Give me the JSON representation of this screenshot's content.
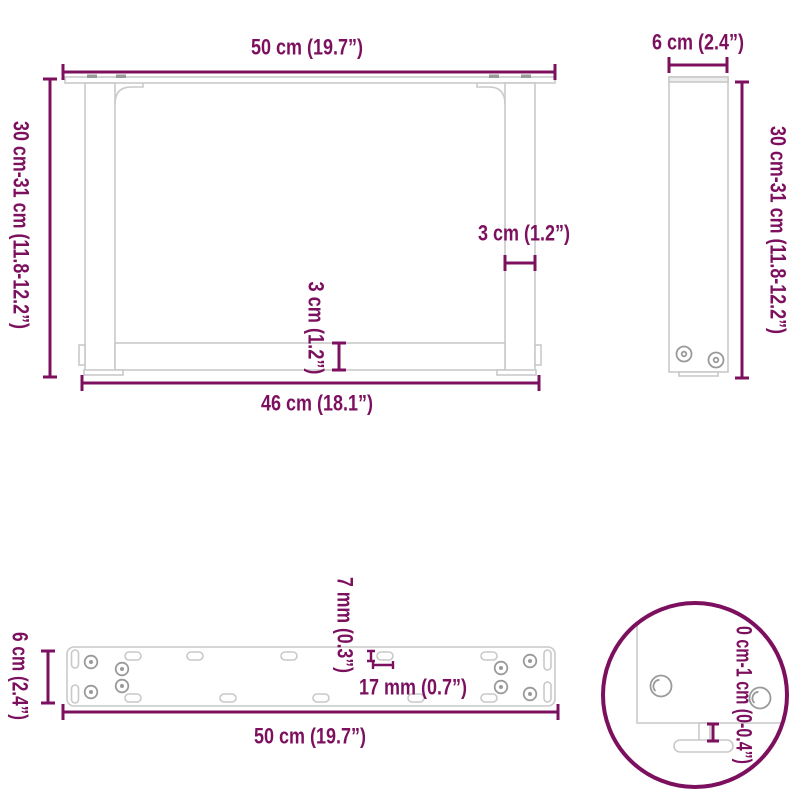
{
  "colors": {
    "accent": "#7C105F",
    "structure": "#C9C9C9",
    "screw": "#9A9A9A",
    "background": "#FFFFFF"
  },
  "front_view": {
    "top_width": "50 cm (19.7”)",
    "height": "30 cm-31 cm (11.8-12.2”)",
    "leg_thickness": "3 cm (1.2”)",
    "crossbar_thickness": "3 cm (1.2”)",
    "bottom_width": "46 cm (18.1”)"
  },
  "side_view": {
    "depth": "6 cm (2.4”)",
    "height": "30 cm-31 cm (11.8-12.2”)"
  },
  "plate_view": {
    "depth": "6 cm (2.4”)",
    "hole_width": "7 mm (0.3”)",
    "hole_length": "17 mm (0.7”)",
    "width": "50 cm (19.7”)"
  },
  "detail_view": {
    "adjustable_foot_range": "0 cm-1 cm (0-0.4”)"
  }
}
